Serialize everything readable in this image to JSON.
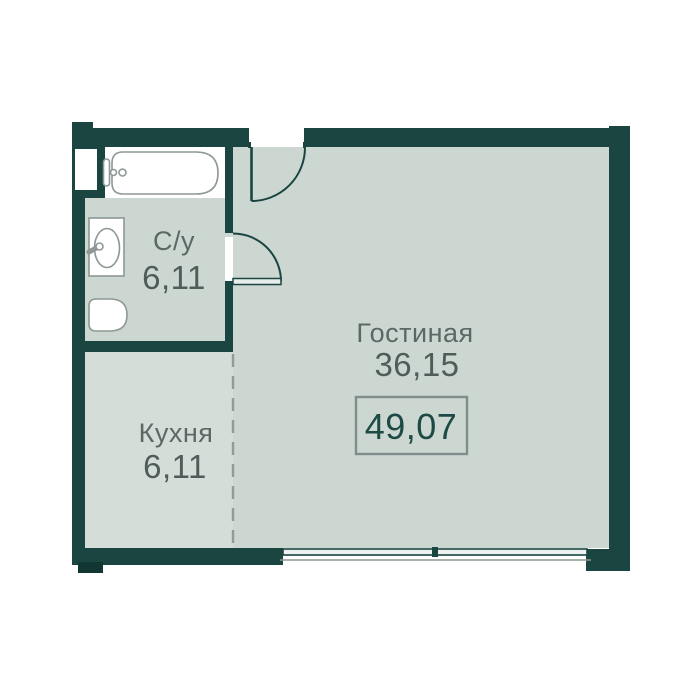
{
  "plan": {
    "type": "apartment-floor-plan",
    "rooms": {
      "bathroom": {
        "name": "С/у",
        "area": "6,11"
      },
      "kitchen": {
        "name": "Кухня",
        "area": "6,11"
      },
      "living": {
        "name": "Гостиная",
        "area": "36,15"
      }
    },
    "total": {
      "area": "49,07"
    },
    "fixtures": [
      "bathtub-icon",
      "sink-icon",
      "toilet-icon"
    ],
    "openings": [
      "entry-door",
      "bathroom-door",
      "window"
    ]
  },
  "colors": {
    "wall": "#1a4541",
    "shadow": "#123732",
    "floor": "#cdd7d2",
    "floor_kitchen": "#d4ddd8",
    "white": "#ffffff",
    "fixture": "#8e9894",
    "label": "#5c6865",
    "number": "#4f5c59",
    "accent": "#1e4a46",
    "dash": "#8f9c98",
    "box_border": "#7f8e8a"
  }
}
